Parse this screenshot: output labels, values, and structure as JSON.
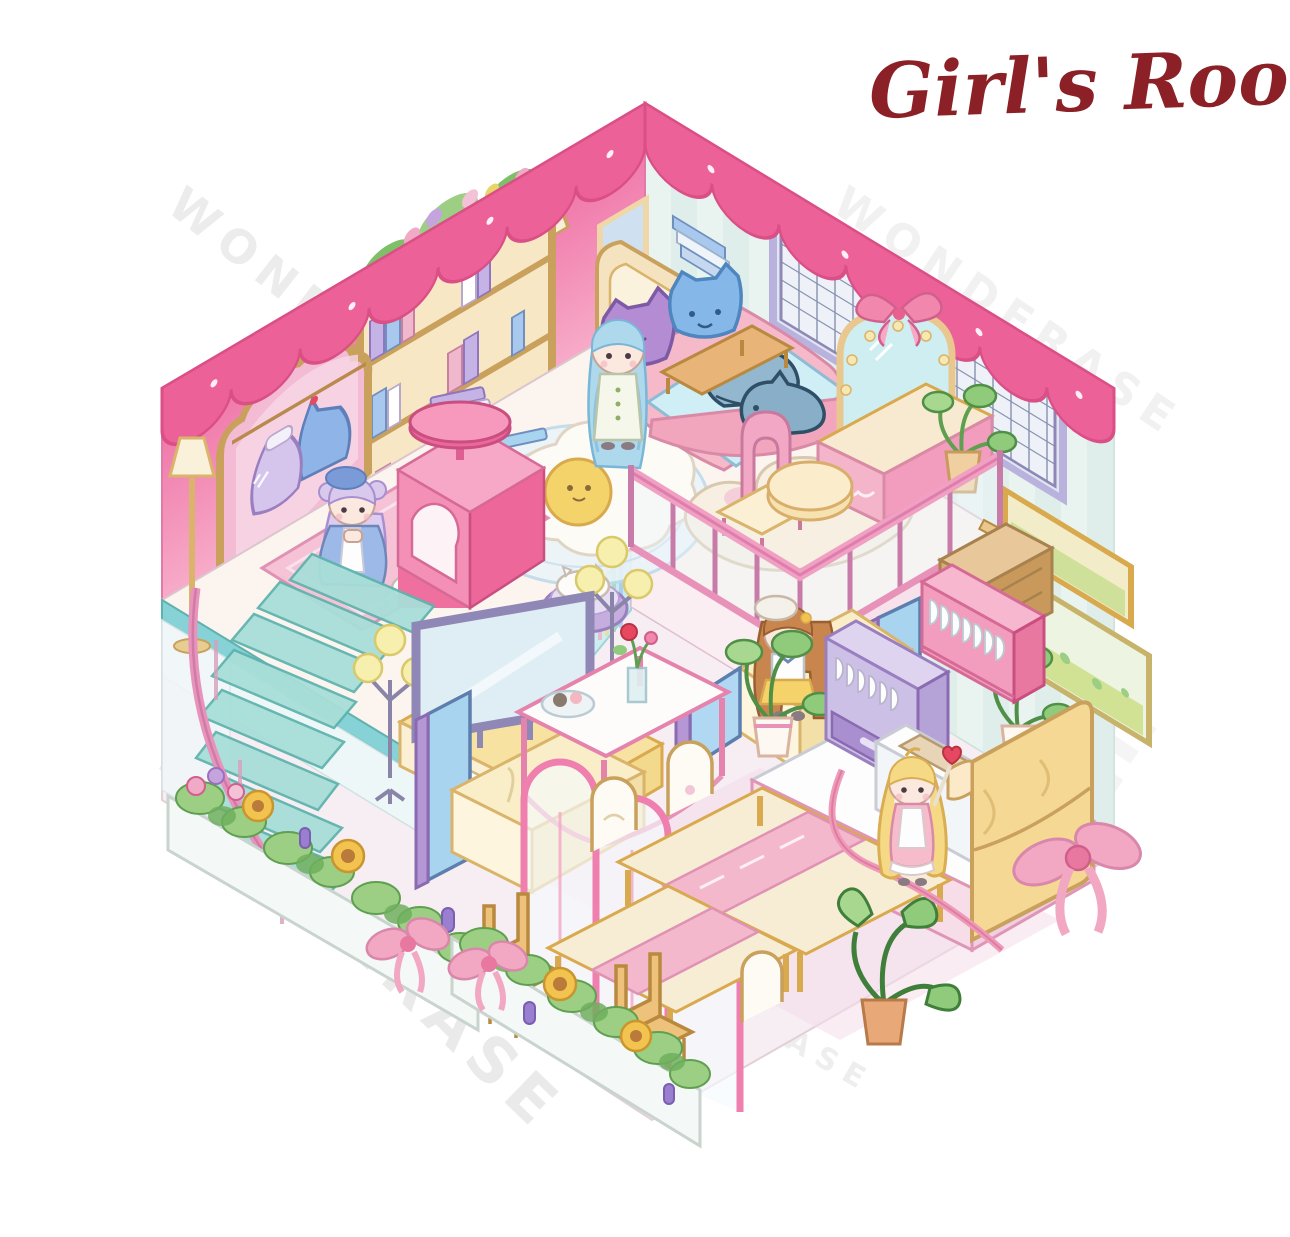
{
  "title": {
    "text": "Girl's Room",
    "color": "#8b2026"
  },
  "watermark": {
    "text": "WONDERASE",
    "color": "#bdbdbd"
  },
  "scene": {
    "type": "isometric-dollhouse-illustration",
    "description": "Pastel cut-away isometric girl's room with loft bedroom, dressing balcony with railing, living room, dining area, kitchen, spiral staircase and flower planters",
    "characters": [
      {
        "name": "girl-blue-hair",
        "hair": "long light-blue",
        "outfit": "white dress with green buttons",
        "location": "standing beside bed in loft bedroom"
      },
      {
        "name": "girl-lavender-hair",
        "hair": "lavender buns with blue beret",
        "outfit": "blue and white dress",
        "location": "sitting on pink rug in loft"
      },
      {
        "name": "girl-brown-hair",
        "hair": "long auburn with white beret",
        "outfit": "white top and yellow skirt",
        "location": "sitting on living-room sofa"
      },
      {
        "name": "girl-blonde-hair",
        "hair": "blonde pigtails",
        "outfit": "pink dress with heart wand",
        "location": "standing in kitchen by fridge"
      }
    ],
    "pets_and_plush": [
      "white-cat-on-rug",
      "white-cat-in-pet-bed",
      "purple-cat-pillow",
      "blue-cat-pillow",
      "shark-plushie",
      "shark-plushie"
    ],
    "furniture": {
      "loft_bedroom": [
        "arched-mirror-wardrobe with hanging dresses",
        "cream-bookshelf with plants and books",
        "floor-lamp",
        "wall-sconce",
        "wall-picture",
        "wall-books",
        "bed with pink blanket and arched headboard",
        "large-grid-window",
        "fried-egg-rug",
        "pink-cat-house with stool top",
        "pink-rug",
        "pet-bed",
        "book-stack"
      ],
      "dressing_balcony": [
        "heart-rug",
        "pink-arch-chair",
        "round-pouf",
        "vanity-mirror with butterfly bow and lights",
        "vanity-table",
        "wooden-bench",
        "potted-plant",
        "pink-railing",
        "side-cabinet"
      ],
      "living_room": [
        "tv on yellow console",
        "floor-lamps with yellow globes",
        "cream-and-blue booth sofas",
        "coffee-table with rose vase and dessert plate",
        "potted-plants",
        "pink-arch-partition"
      ],
      "dining_area": [
        "long-dining-tables with pink runners",
        "white-back-chairs",
        "wooden-chairs",
        "kitchen-island",
        "potted-plant"
      ],
      "kitchen": [
        "pink-dish-shelf",
        "purple-dish-cabinet",
        "sink-counter",
        "yellow-fridge",
        "green-window",
        "menu-boards",
        "pink-ribbon-with-bow"
      ],
      "exterior": [
        "spiral-staircase",
        "flower-planters with sunflowers, roses, tulips and pink bows"
      ]
    },
    "palette": {
      "wall_pink": "#f28ab5",
      "valance_pink": "#ec6298",
      "wall_mint": "#e9f4f0",
      "wall_stripe": "#d8eae6",
      "floor_loft": "#fcf4ee",
      "floor_lower": "#f7eef3",
      "loft_edge_teal": "#86d2d6",
      "railing_pink": "#f0a0c2",
      "stairs_teal": "#a8ded8",
      "stairs_rail_pink": "#e893bb",
      "bed_pink": "#f6b9ca",
      "headboard_cream": "#f5e3c0",
      "window_lavender": "#c9c3e8",
      "sofa_cream": "#faeec9",
      "sofa_blue": "#a9d4f0",
      "sofa_purple": "#b697d6",
      "tv_frame": "#8f87b5",
      "console_yellow": "#f8e2a2",
      "fridge_yellow": "#f4d894",
      "dish_shelf_pink": "#f29dbd",
      "cabinet_purple": "#cdc0e6",
      "plant_green": "#8fcb7a",
      "sunflower_yellow": "#f2c34e",
      "egg_yolk": "#f3d36a",
      "gold_frame": "#e9c88f",
      "title_red": "#8b2026"
    }
  }
}
